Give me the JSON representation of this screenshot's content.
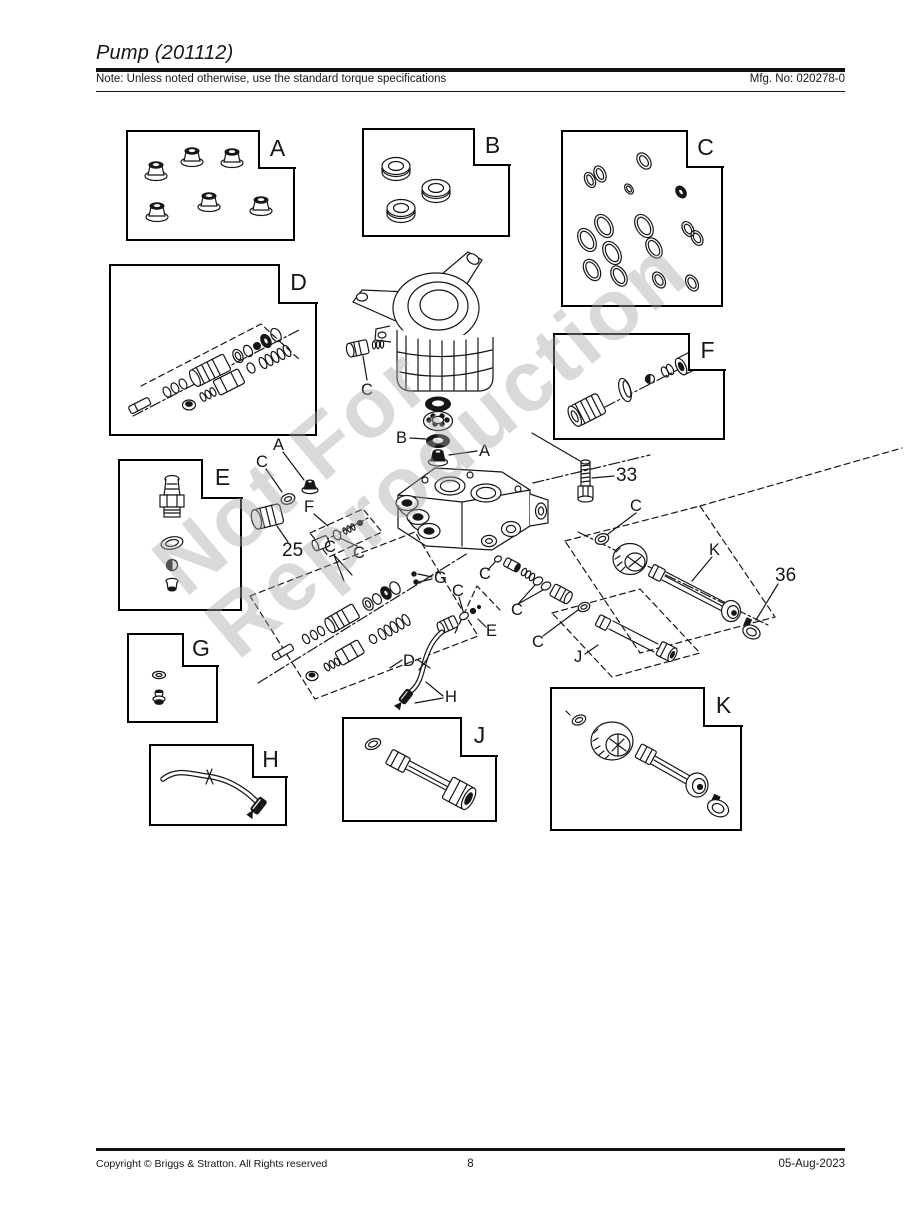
{
  "header": {
    "title": "Pump (201112)",
    "note": "Note: Unless noted otherwise, use the standard torque specifications",
    "mfg": "Mfg. No: 020278-0"
  },
  "footer": {
    "copyright": "Copyright ©  Briggs & Stratton. All Rights reserved",
    "page_number": "8",
    "date": "05-Aug-2023"
  },
  "watermark": {
    "line1": "Not For",
    "line2": "Reproduction"
  },
  "boxes": [
    {
      "id": "A",
      "label": "A",
      "contents": "flange nuts x6"
    },
    {
      "id": "B",
      "label": "B",
      "contents": "oil seals x3"
    },
    {
      "id": "C",
      "label": "C",
      "contents": "o-ring kit"
    },
    {
      "id": "D",
      "label": "D",
      "contents": "unloader valve assembly"
    },
    {
      "id": "E",
      "label": "E",
      "contents": "thermal relief kit"
    },
    {
      "id": "F",
      "label": "F",
      "contents": "check valve kit"
    },
    {
      "id": "G",
      "label": "G",
      "contents": "o-ring and screw"
    },
    {
      "id": "H",
      "label": "H",
      "contents": "hose with fitting"
    },
    {
      "id": "J",
      "label": "J",
      "contents": "outlet tube"
    },
    {
      "id": "K",
      "label": "K",
      "contents": "outlet tube kit"
    }
  ],
  "callouts": {
    "A": "A",
    "B": "B",
    "C": "C",
    "D": "D",
    "E": "E",
    "F": "F",
    "G": "G",
    "H": "H",
    "J": "J",
    "K": "K",
    "n25": "25",
    "n33": "33",
    "n36": "36"
  }
}
